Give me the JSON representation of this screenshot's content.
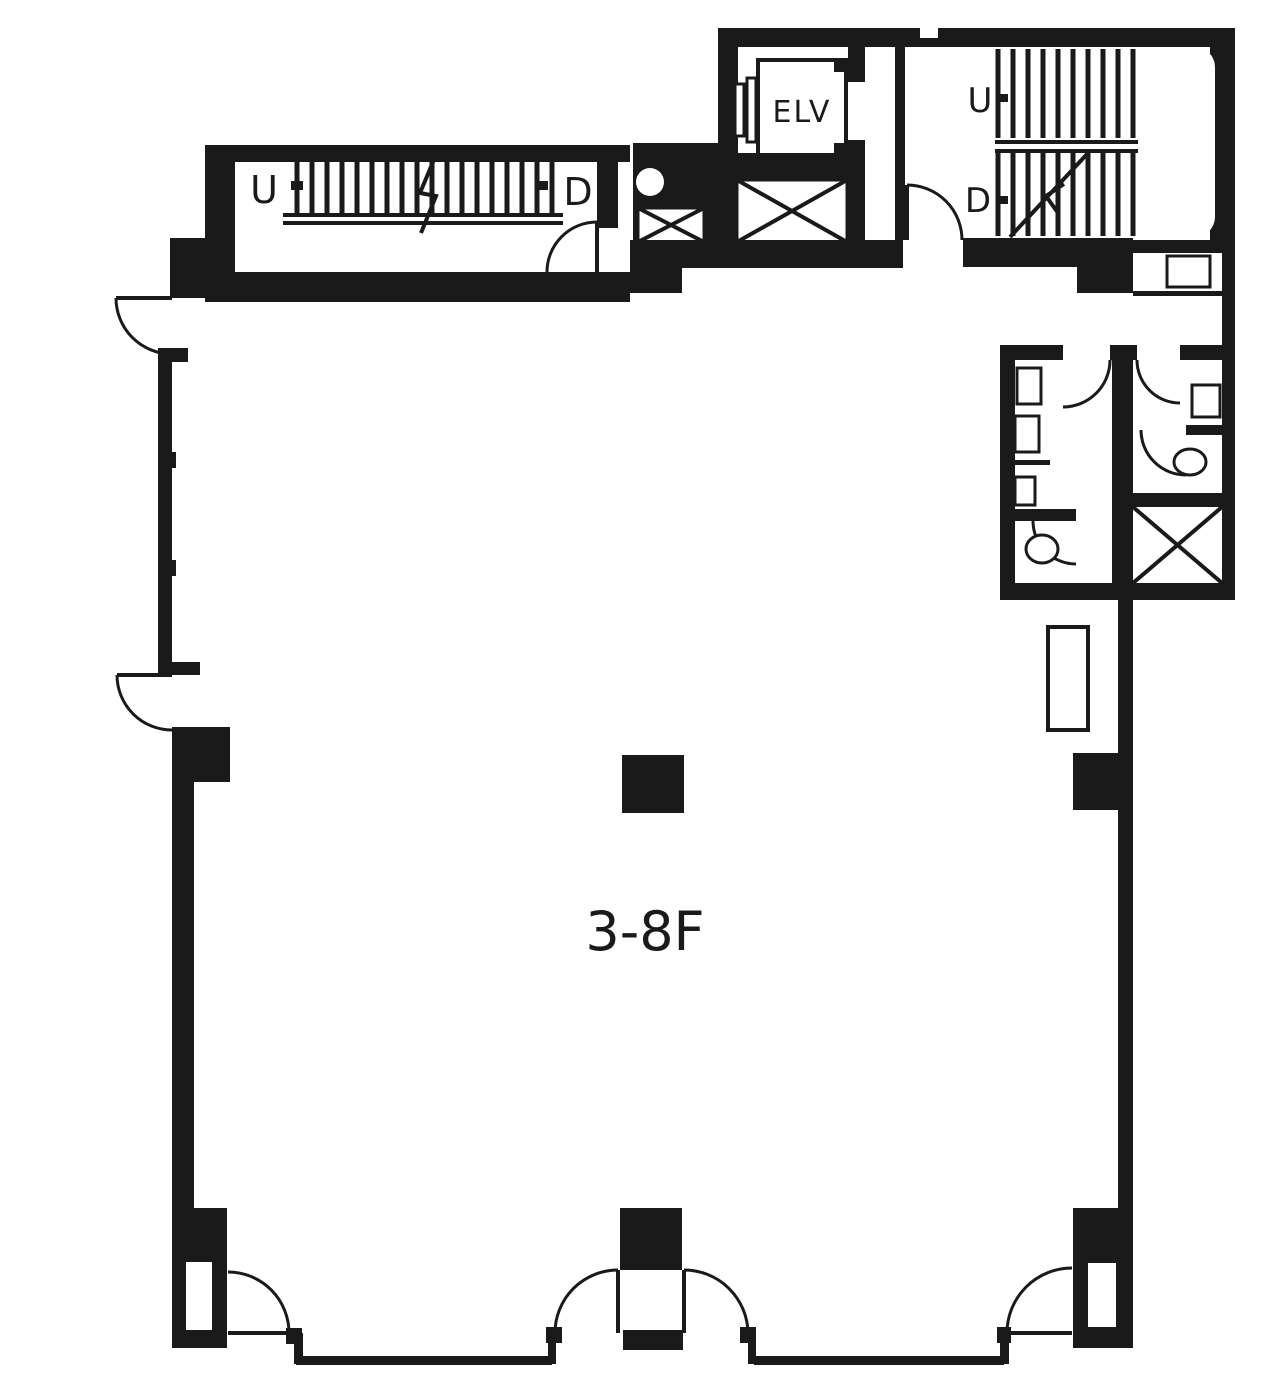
{
  "colors": {
    "ink": "#1a1a1a",
    "bg": "#ffffff"
  },
  "plan": {
    "floor_label": "3-8F",
    "elevator_label": "ELV",
    "stairs_left": {
      "up": "U",
      "down": "D"
    },
    "stairs_right": {
      "up": "U",
      "down": "D"
    }
  }
}
